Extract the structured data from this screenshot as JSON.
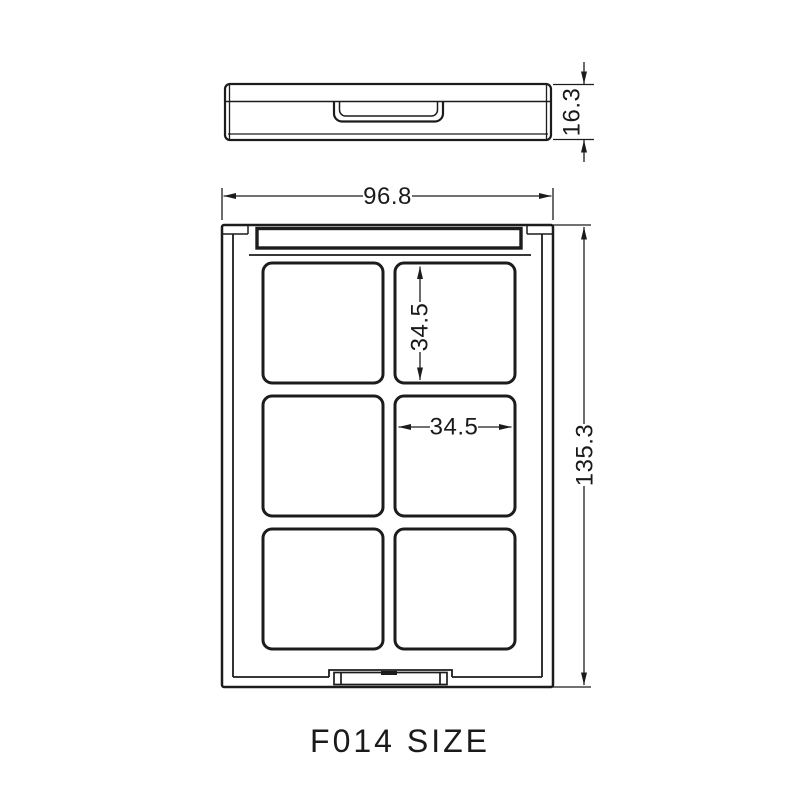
{
  "title": "F014 SIZE",
  "colors": {
    "line": "#1c1c1c",
    "background": "#ffffff"
  },
  "dimensions": {
    "case_thickness_mm": "16.3",
    "overall_width_mm": "96.8",
    "overall_height_mm": "135.3",
    "pan_height_mm": "34.5",
    "pan_width_mm": "34.5"
  }
}
